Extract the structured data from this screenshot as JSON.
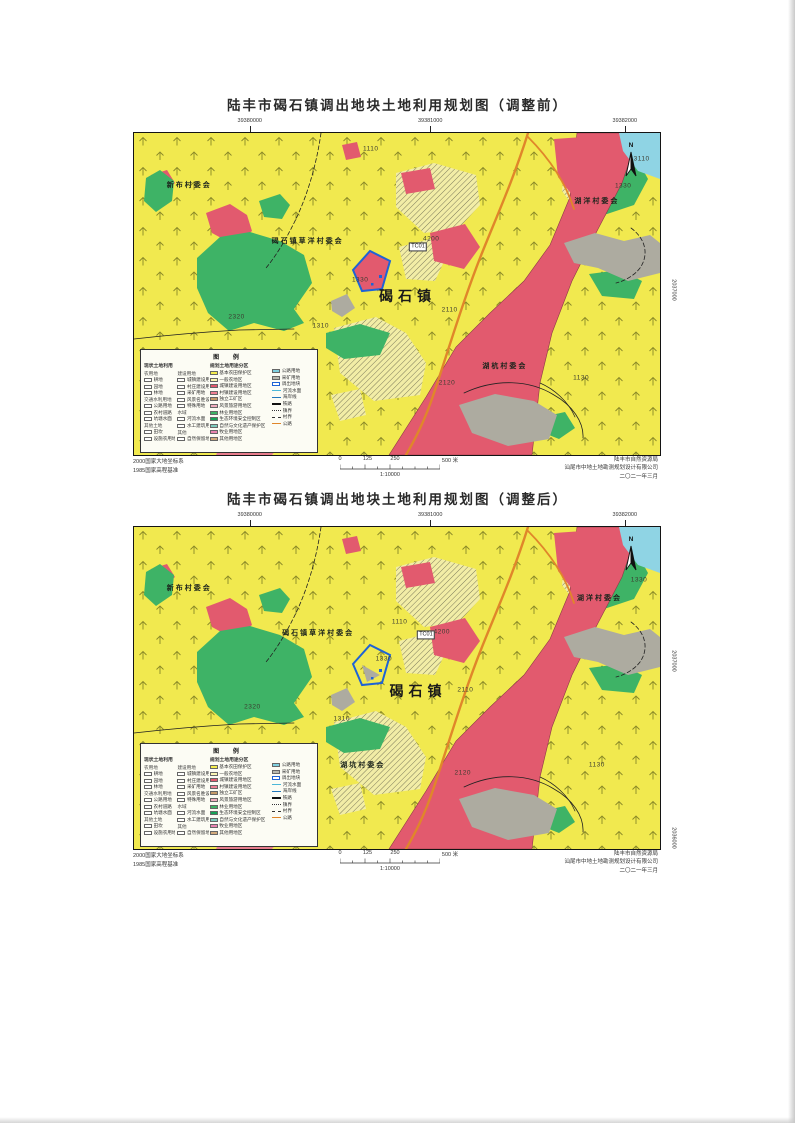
{
  "compass_label": "N",
  "map_colors": {
    "farmland_yellow": "#f1e94f",
    "hatch_base": "#f2eda6",
    "urban_red": "#e25a6e",
    "urban_pink": "#e87c8c",
    "forest_green": "#3eb366",
    "open_gray": "#adaba0",
    "sea_cyan": "#8fd4e4",
    "road_orange": "#e0862a",
    "parcel_blue": "#1e63d6"
  },
  "maps": [
    {
      "title": "陆丰市碣石镇调出地块土地利用规划图（调整前）",
      "top_coords": [
        "39380000",
        "39381000",
        "39382000"
      ],
      "right_coords": [
        {
          "text": "2037000",
          "y_pct": 49
        }
      ],
      "labels": [
        {
          "text": "新布村委会",
          "x_pct": 10.5,
          "y_pct": 16,
          "cls": "village"
        },
        {
          "text": "碣石镇草洋村委会",
          "x_pct": 33,
          "y_pct": 33.5,
          "cls": "village"
        },
        {
          "text": "湖洋村委会",
          "x_pct": 88,
          "y_pct": 21,
          "cls": "village"
        },
        {
          "text": "湖杭村委会",
          "x_pct": 70.5,
          "y_pct": 72.5,
          "cls": "village"
        },
        {
          "text": "碣石镇",
          "x_pct": 52,
          "y_pct": 50.5,
          "cls": "town"
        },
        {
          "text": "1110",
          "x_pct": 45,
          "y_pct": 5,
          "cls": "code"
        },
        {
          "text": "3110",
          "x_pct": 96.5,
          "y_pct": 8,
          "cls": "code"
        },
        {
          "text": "1330",
          "x_pct": 93,
          "y_pct": 16.5,
          "cls": "code"
        },
        {
          "text": "4200",
          "x_pct": 56.5,
          "y_pct": 33,
          "cls": "code"
        },
        {
          "text": "TC01",
          "x_pct": 54,
          "y_pct": 35.5,
          "cls": "box"
        },
        {
          "text": "1330",
          "x_pct": 43,
          "y_pct": 45.5,
          "cls": "code"
        },
        {
          "text": "2320",
          "x_pct": 19.5,
          "y_pct": 57,
          "cls": "code"
        },
        {
          "text": "1310",
          "x_pct": 35.5,
          "y_pct": 60,
          "cls": "code"
        },
        {
          "text": "2110",
          "x_pct": 60,
          "y_pct": 55,
          "cls": "code"
        },
        {
          "text": "2120",
          "x_pct": 59.5,
          "y_pct": 77.5,
          "cls": "code"
        },
        {
          "text": "1130",
          "x_pct": 85,
          "y_pct": 76,
          "cls": "code"
        }
      ]
    },
    {
      "title": "陆丰市碣石镇调出地块土地利用规划图（调整后）",
      "top_coords": [
        "39380000",
        "39381000",
        "39382000"
      ],
      "right_coords": [
        {
          "text": "2037000",
          "y_pct": 42
        },
        {
          "text": "2036000",
          "y_pct": 97
        }
      ],
      "labels": [
        {
          "text": "新布村委会",
          "x_pct": 10.5,
          "y_pct": 19,
          "cls": "village"
        },
        {
          "text": "碣石镇草洋村委会",
          "x_pct": 35,
          "y_pct": 33,
          "cls": "village"
        },
        {
          "text": "湖洋村委会",
          "x_pct": 88.5,
          "y_pct": 22,
          "cls": "village"
        },
        {
          "text": "湖坑村委会",
          "x_pct": 43.5,
          "y_pct": 74,
          "cls": "village"
        },
        {
          "text": "碣石镇",
          "x_pct": 54,
          "y_pct": 51,
          "cls": "town"
        },
        {
          "text": "1110",
          "x_pct": 50.5,
          "y_pct": 29.5,
          "cls": "code"
        },
        {
          "text": "1330",
          "x_pct": 96,
          "y_pct": 16.5,
          "cls": "code"
        },
        {
          "text": "4200",
          "x_pct": 58.5,
          "y_pct": 32.5,
          "cls": "code"
        },
        {
          "text": "TC01",
          "x_pct": 55.5,
          "y_pct": 33.5,
          "cls": "box"
        },
        {
          "text": "1330",
          "x_pct": 47.5,
          "y_pct": 41,
          "cls": "code"
        },
        {
          "text": "2320",
          "x_pct": 22.5,
          "y_pct": 56,
          "cls": "code"
        },
        {
          "text": "1310",
          "x_pct": 39.5,
          "y_pct": 59.5,
          "cls": "code"
        },
        {
          "text": "2110",
          "x_pct": 63,
          "y_pct": 50.5,
          "cls": "code"
        },
        {
          "text": "2120",
          "x_pct": 62.5,
          "y_pct": 76.5,
          "cls": "code"
        },
        {
          "text": "1130",
          "x_pct": 88,
          "y_pct": 74,
          "cls": "code"
        }
      ]
    }
  ],
  "legend": {
    "title": "图 例",
    "left_header": "现状土地利用",
    "plan_header": "规划土地用途分区",
    "left_col_a": [
      {
        "h": "农用地"
      },
      {
        "t": "耕地"
      },
      {
        "t": "园地"
      },
      {
        "t": "林地"
      },
      {
        "h": "交通水利用地"
      },
      {
        "t": "公路用地"
      },
      {
        "t": "农村道路"
      },
      {
        "t": "坑塘水面"
      },
      {
        "h": "其他土地"
      },
      {
        "t": "田坎"
      },
      {
        "t": "设施农用地"
      }
    ],
    "left_col_b": [
      {
        "h": "建设用地"
      },
      {
        "t": "城镇建设用地"
      },
      {
        "t": "村庄建设用地"
      },
      {
        "t": "采矿用地"
      },
      {
        "t": "风景名胜设施用地"
      },
      {
        "t": "特殊用地"
      },
      {
        "h": "水域"
      },
      {
        "t": "河流水面"
      },
      {
        "t": "水工建筑用地"
      },
      {
        "h": "其他"
      },
      {
        "t": "自然保留地"
      }
    ],
    "plan_items": [
      {
        "t": "基本农田保护区",
        "c": "#f3ec4e"
      },
      {
        "t": "一般农地区",
        "c": "#faf6b4"
      },
      {
        "t": "城镇建设用地区",
        "c": "#e25a6e"
      },
      {
        "t": "村镇建设用地区",
        "c": "#ef8094"
      },
      {
        "t": "独立工矿区",
        "c": "#c59a69"
      },
      {
        "t": "风景旅游用地区",
        "c": "#f0aebf"
      },
      {
        "t": "林业用地区",
        "c": "#3eb366"
      },
      {
        "t": "生态环境安全控制区",
        "c": "#17a257"
      },
      {
        "t": "自然与文化遗产保护区",
        "c": "#7fcbbd"
      },
      {
        "t": "牧业用地区",
        "c": "#e984b0"
      },
      {
        "t": "其他用地区",
        "c": "#d2aa7c"
      }
    ],
    "aux_items": [
      {
        "t": "公路用地",
        "c": "#7fd0e0"
      },
      {
        "t": "采矿用地",
        "c": "#b9b9af"
      },
      {
        "t": "调出地块",
        "c": "#ffffff",
        "bc": "#1e63d6"
      },
      {
        "t": "河流水面",
        "line": "#4db8d8"
      },
      {
        "t": "海岸线",
        "line": "#2277bb"
      },
      {
        "t": "铁路",
        "rail": true
      },
      {
        "t": "镇界",
        "line": "#333333",
        "dash": "dashdot"
      },
      {
        "t": "村界",
        "line": "#333333",
        "dash": "dash"
      },
      {
        "t": "公路",
        "line": "#e0862a"
      }
    ]
  },
  "footer": {
    "datum_lines": [
      "2000国家大地坐标系",
      "1985国家高程基准"
    ],
    "scale": {
      "ticks": [
        "0",
        "125",
        "250",
        "500"
      ],
      "unit": "米",
      "ratio": "1:10000"
    },
    "attribution": [
      "陆丰市自然资源局",
      "汕尾市中地土地勘测规划设计有限公司",
      "二〇二一年三月"
    ]
  }
}
